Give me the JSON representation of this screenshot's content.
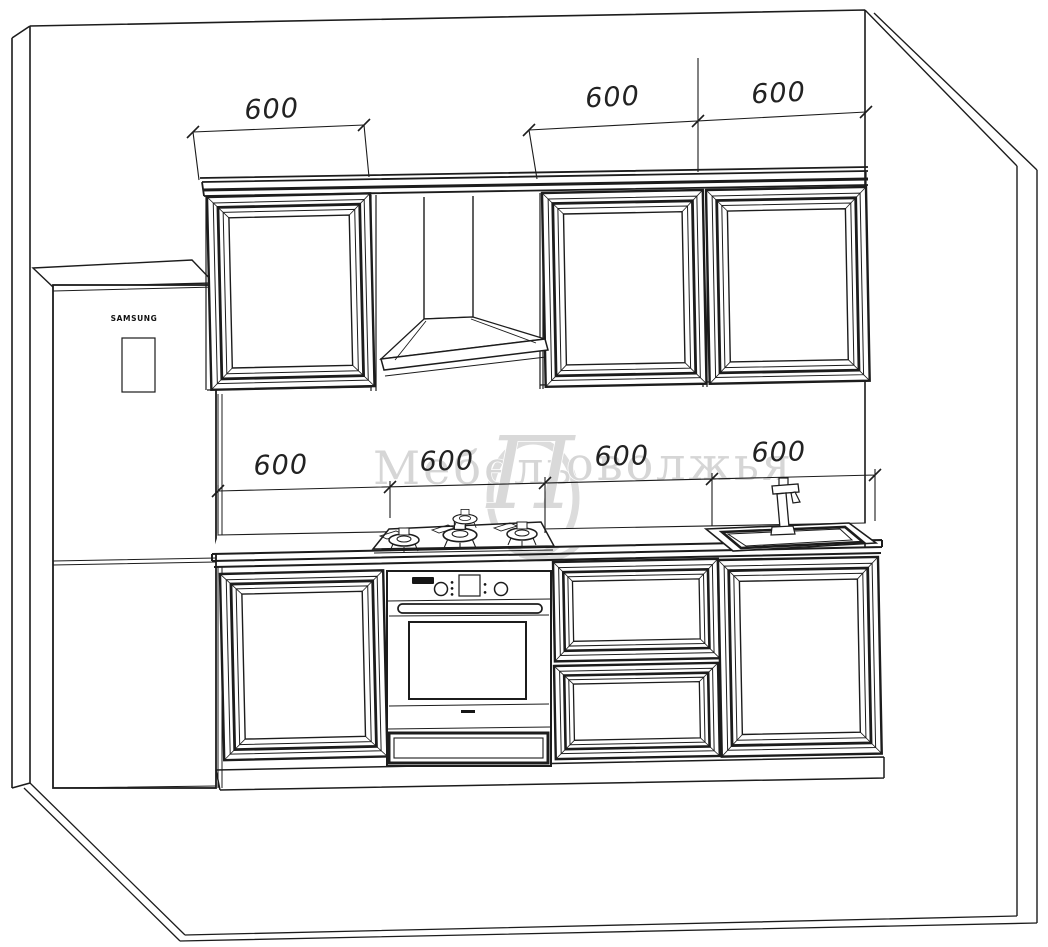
{
  "drawing": {
    "kind": "kitchen-elevation-line-drawing",
    "colors": {
      "background": "#ffffff",
      "line": "#1c1c1c",
      "watermark": "#d6d6d6"
    }
  },
  "watermark": {
    "part1": "Мебель",
    "initial": "П",
    "part2": "оволжья",
    "full": "Мебель Поволжья"
  },
  "fridge": {
    "brand": "SAMSUNG"
  },
  "dimensions": {
    "top": [
      "600",
      "600",
      "600"
    ],
    "middle": [
      "600",
      "600",
      "600",
      "600"
    ]
  }
}
